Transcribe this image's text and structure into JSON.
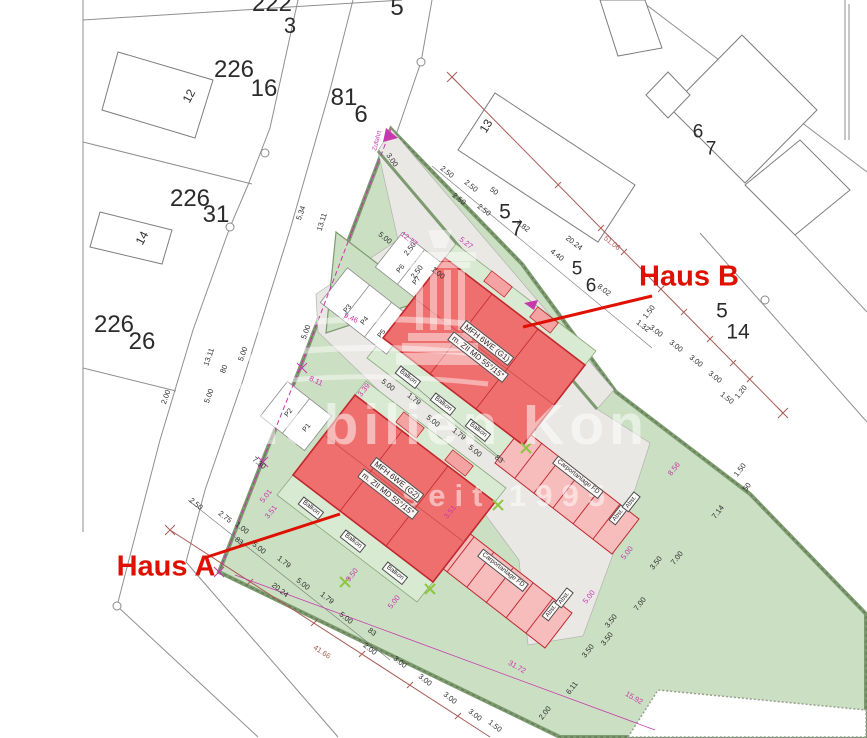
{
  "watermark": {
    "line1": "mobilien Kon",
    "line2": "seit 1995"
  },
  "colors": {
    "ink": "#2b2b2b",
    "m": "#c837ae",
    "rb": "#a85c55",
    "red": "#e01000",
    "site_green": "#cbdfc2",
    "terrace_green": "#d9ead2",
    "paving_gray": "#e9e8e5",
    "building_red": "#ef6f6e",
    "building_outline": "#c1272d",
    "carport_pink": "#f7bdbd",
    "survey_lime": "#8dc63f"
  },
  "labels": [
    {
      "t": "222",
      "x": 272,
      "y": 4,
      "s": 24,
      "n": "parcel-222"
    },
    {
      "t": "3",
      "x": 290,
      "y": 26,
      "s": 22
    },
    {
      "t": "226",
      "x": 234,
      "y": 70,
      "s": 24,
      "n": "parcel-226-16"
    },
    {
      "t": "16",
      "x": 264,
      "y": 89,
      "s": 24
    },
    {
      "t": "12",
      "x": 189,
      "y": 96,
      "r": -62,
      "s": 12,
      "n": "house-number-12"
    },
    {
      "t": "226",
      "x": 190,
      "y": 199,
      "s": 24,
      "n": "parcel-226-31"
    },
    {
      "t": "31",
      "x": 216,
      "y": 215,
      "s": 24
    },
    {
      "t": "14",
      "x": 142,
      "y": 238,
      "r": -62,
      "s": 12,
      "n": "house-number-14"
    },
    {
      "t": "226",
      "x": 114,
      "y": 325,
      "s": 24,
      "n": "parcel-226-26"
    },
    {
      "t": "26",
      "x": 142,
      "y": 342,
      "s": 24
    },
    {
      "t": "81",
      "x": 344,
      "y": 98,
      "s": 24,
      "n": "parcel-81-6"
    },
    {
      "t": "6",
      "x": 361,
      "y": 115,
      "s": 24
    },
    {
      "t": "5",
      "x": 397,
      "y": 8,
      "s": 24,
      "n": "parcel-5"
    },
    {
      "t": "13",
      "x": 486,
      "y": 126,
      "r": -58,
      "s": 12,
      "n": "house-number-13"
    },
    {
      "t": "5",
      "x": 505,
      "y": 212,
      "s": 21,
      "n": "parcel-5-7"
    },
    {
      "t": "7",
      "x": 517,
      "y": 229,
      "s": 21
    },
    {
      "t": "5",
      "x": 577,
      "y": 269,
      "s": 19,
      "n": "parcel-5-6"
    },
    {
      "t": "6",
      "x": 591,
      "y": 286,
      "s": 19
    },
    {
      "t": "6",
      "x": 698,
      "y": 132,
      "s": 19,
      "n": "parcel-6-7"
    },
    {
      "t": "7",
      "x": 711,
      "y": 149,
      "s": 19
    },
    {
      "t": "5",
      "x": 722,
      "y": 311,
      "s": 21,
      "n": "parcel-5-14"
    },
    {
      "t": "14",
      "x": 738,
      "y": 332,
      "s": 21
    },
    {
      "t": "Haus B",
      "x": 689,
      "y": 277,
      "s": 29,
      "c": "red",
      "fw": 1,
      "n": "haus-b-label"
    },
    {
      "t": "Haus A",
      "x": 166,
      "y": 567,
      "s": 29,
      "c": "red",
      "fw": 1,
      "n": "haus-a-label"
    },
    {
      "t": "MFH 6WE (G1)",
      "x": 487,
      "y": 343,
      "r": 38,
      "s": 8,
      "b": 1,
      "n": "haus-b-type-label"
    },
    {
      "t": "m. ZII MD 55°/15°",
      "x": 478,
      "y": 357,
      "r": 38,
      "s": 8,
      "b": 1,
      "n": "haus-b-roof-label"
    },
    {
      "t": "MFH 6WE (G2)",
      "x": 397,
      "y": 480,
      "r": 38,
      "s": 8,
      "b": 1,
      "n": "haus-a-type-label"
    },
    {
      "t": "m. ZII MD 55°/15°",
      "x": 388,
      "y": 494,
      "r": 38,
      "s": 8,
      "b": 1,
      "n": "haus-a-roof-label"
    },
    {
      "t": "Balkon",
      "x": 408,
      "y": 377,
      "r": 38,
      "s": 6.5,
      "b": 1
    },
    {
      "t": "Balkon",
      "x": 443,
      "y": 404,
      "r": 38,
      "s": 6.5,
      "b": 1
    },
    {
      "t": "Balkon",
      "x": 478,
      "y": 430,
      "r": 38,
      "s": 6.5,
      "b": 1
    },
    {
      "t": "Balkon",
      "x": 311,
      "y": 508,
      "r": 38,
      "s": 6.5,
      "b": 1
    },
    {
      "t": "Balkon",
      "x": 353,
      "y": 541,
      "r": 38,
      "s": 6.5,
      "b": 1
    },
    {
      "t": "Balkon",
      "x": 395,
      "y": 573,
      "r": 38,
      "s": 6.5,
      "b": 1
    },
    {
      "t": "Carportanlage FD",
      "x": 578,
      "y": 477,
      "r": 38,
      "s": 6.5,
      "b": 1
    },
    {
      "t": "Carportanlage FD",
      "x": 503,
      "y": 570,
      "r": 38,
      "s": 6.5,
      "b": 1
    },
    {
      "t": "Abst.",
      "x": 618,
      "y": 515,
      "r": -52,
      "s": 6,
      "b": 1
    },
    {
      "t": "Abst.",
      "x": 631,
      "y": 502,
      "r": -52,
      "s": 6,
      "b": 1
    },
    {
      "t": "Abst.",
      "x": 551,
      "y": 611,
      "r": -52,
      "s": 6,
      "b": 1
    },
    {
      "t": "Abst.",
      "x": 564,
      "y": 598,
      "r": -52,
      "s": 6,
      "b": 1
    },
    {
      "t": "P1",
      "x": 307,
      "y": 428,
      "r": -52,
      "s": 7
    },
    {
      "t": "P2",
      "x": 289,
      "y": 413,
      "r": -52,
      "s": 7
    },
    {
      "t": "P3",
      "x": 348,
      "y": 309,
      "r": -52,
      "s": 7
    },
    {
      "t": "P4",
      "x": 365,
      "y": 321,
      "r": -52,
      "s": 7
    },
    {
      "t": "P5",
      "x": 382,
      "y": 334,
      "r": -52,
      "s": 7
    },
    {
      "t": "P6",
      "x": 401,
      "y": 269,
      "r": -52,
      "s": 7
    },
    {
      "t": "P7",
      "x": 417,
      "y": 281,
      "r": -52,
      "s": 7
    },
    {
      "t": "Zufahrt",
      "x": 378,
      "y": 141,
      "r": -75,
      "s": 6.5,
      "c": "m",
      "n": "zufahrt-label"
    },
    {
      "t": "2.50",
      "x": 447,
      "y": 172,
      "r": 38
    },
    {
      "t": "2.50",
      "x": 471,
      "y": 186,
      "r": 38
    },
    {
      "t": "2.50",
      "x": 459,
      "y": 199,
      "r": 38
    },
    {
      "t": "50",
      "x": 494,
      "y": 191,
      "r": 38
    },
    {
      "t": "2.50",
      "x": 484,
      "y": 210,
      "r": 38
    },
    {
      "t": "7.82",
      "x": 523,
      "y": 226,
      "r": 38
    },
    {
      "t": "20.24",
      "x": 574,
      "y": 243,
      "r": 38
    },
    {
      "t": "3.00",
      "x": 392,
      "y": 160,
      "r": 55
    },
    {
      "t": "4.40",
      "x": 557,
      "y": 255,
      "r": 38
    },
    {
      "t": "8.02",
      "x": 604,
      "y": 290,
      "r": 38
    },
    {
      "t": "1.50",
      "x": 649,
      "y": 312,
      "r": -52
    },
    {
      "t": "1.32",
      "x": 643,
      "y": 326,
      "r": 38
    },
    {
      "t": "3.00",
      "x": 656,
      "y": 331,
      "r": 38
    },
    {
      "t": "3.00",
      "x": 676,
      "y": 346,
      "r": 38
    },
    {
      "t": "3.00",
      "x": 696,
      "y": 361,
      "r": 38
    },
    {
      "t": "3.00",
      "x": 715,
      "y": 377,
      "r": 38
    },
    {
      "t": "1.50",
      "x": 727,
      "y": 398,
      "r": 38
    },
    {
      "t": "1.20",
      "x": 741,
      "y": 392,
      "r": -52
    },
    {
      "t": "51.06",
      "x": 612,
      "y": 243,
      "r": 38,
      "c": "rb"
    },
    {
      "t": "2.00",
      "x": 166,
      "y": 397,
      "r": -70
    },
    {
      "t": "5.00",
      "x": 209,
      "y": 396,
      "r": -70
    },
    {
      "t": "80",
      "x": 224,
      "y": 369,
      "r": -70
    },
    {
      "t": "13.11",
      "x": 209,
      "y": 357,
      "r": -70
    },
    {
      "t": "5.00",
      "x": 243,
      "y": 354,
      "r": -70
    },
    {
      "t": "5.34",
      "x": 301,
      "y": 213,
      "r": -70
    },
    {
      "t": "13.11",
      "x": 322,
      "y": 222,
      "r": -72
    },
    {
      "t": "5.00",
      "x": 306,
      "y": 332,
      "r": -70
    },
    {
      "t": "5.00",
      "x": 385,
      "y": 238,
      "r": 38
    },
    {
      "t": "1.00",
      "x": 438,
      "y": 273,
      "r": 38
    },
    {
      "t": "2.50",
      "x": 410,
      "y": 249,
      "r": -52
    },
    {
      "t": "2.50",
      "x": 417,
      "y": 272,
      "r": -52
    },
    {
      "t": "12.77",
      "x": 409,
      "y": 239,
      "r": 38,
      "c": "m"
    },
    {
      "t": "5.27",
      "x": 466,
      "y": 243,
      "r": 38,
      "c": "m"
    },
    {
      "t": "9.46",
      "x": 351,
      "y": 318,
      "r": 25,
      "c": "m"
    },
    {
      "t": "8.11",
      "x": 316,
      "y": 381,
      "r": 25,
      "c": "m"
    },
    {
      "t": "3.39",
      "x": 364,
      "y": 390,
      "r": -52,
      "c": "m"
    },
    {
      "t": "5.00",
      "x": 388,
      "y": 385,
      "r": 38
    },
    {
      "t": "1.79",
      "x": 414,
      "y": 399,
      "r": 38
    },
    {
      "t": "5.00",
      "x": 433,
      "y": 421,
      "r": 38
    },
    {
      "t": "1.79",
      "x": 459,
      "y": 434,
      "r": 38
    },
    {
      "t": "5.00",
      "x": 475,
      "y": 451,
      "r": 38
    },
    {
      "t": "83",
      "x": 499,
      "y": 459,
      "r": 38
    },
    {
      "t": "7.30",
      "x": 259,
      "y": 463,
      "r": 38
    },
    {
      "t": "5.01",
      "x": 266,
      "y": 496,
      "r": -52,
      "c": "m"
    },
    {
      "t": "3.51",
      "x": 271,
      "y": 512,
      "r": -52,
      "c": "m"
    },
    {
      "t": "3.51",
      "x": 450,
      "y": 512,
      "r": -52,
      "c": "m"
    },
    {
      "t": "3.50",
      "x": 352,
      "y": 575,
      "r": -52,
      "c": "m"
    },
    {
      "t": "5.00",
      "x": 394,
      "y": 602,
      "r": -52,
      "c": "m"
    },
    {
      "t": "2.50",
      "x": 196,
      "y": 504,
      "r": 38
    },
    {
      "t": "2.75",
      "x": 225,
      "y": 517,
      "r": 38
    },
    {
      "t": "1.00",
      "x": 242,
      "y": 528,
      "r": 38
    },
    {
      "t": "83",
      "x": 239,
      "y": 541,
      "r": 38
    },
    {
      "t": "5.00",
      "x": 259,
      "y": 548,
      "r": 38
    },
    {
      "t": "1.79",
      "x": 284,
      "y": 562,
      "r": 38
    },
    {
      "t": "5.00",
      "x": 303,
      "y": 584,
      "r": 38
    },
    {
      "t": "1.79",
      "x": 327,
      "y": 598,
      "r": 38
    },
    {
      "t": "5.00",
      "x": 346,
      "y": 618,
      "r": 38
    },
    {
      "t": "83",
      "x": 372,
      "y": 632,
      "r": 38
    },
    {
      "t": "2.00",
      "x": 370,
      "y": 649,
      "r": 38
    },
    {
      "t": "20.24",
      "x": 280,
      "y": 590,
      "r": 38
    },
    {
      "t": "41.66",
      "x": 322,
      "y": 652,
      "r": 33,
      "c": "rb"
    },
    {
      "t": "3.00",
      "x": 400,
      "y": 662,
      "r": 38
    },
    {
      "t": "3.00",
      "x": 425,
      "y": 680,
      "r": 38
    },
    {
      "t": "3.00",
      "x": 450,
      "y": 698,
      "r": 38
    },
    {
      "t": "3.00",
      "x": 475,
      "y": 715,
      "r": 38
    },
    {
      "t": "1.50",
      "x": 495,
      "y": 726,
      "r": 38
    },
    {
      "t": "5.00",
      "x": 589,
      "y": 597,
      "r": -52,
      "c": "m"
    },
    {
      "t": "5.00",
      "x": 627,
      "y": 553,
      "r": -52,
      "c": "m"
    },
    {
      "t": "8.56",
      "x": 674,
      "y": 469,
      "r": -52,
      "c": "m"
    },
    {
      "t": "1.50",
      "x": 740,
      "y": 470,
      "r": -52
    },
    {
      "t": "50",
      "x": 747,
      "y": 487,
      "r": -52
    },
    {
      "t": "7.14",
      "x": 718,
      "y": 512,
      "r": -52
    },
    {
      "t": "3.50",
      "x": 656,
      "y": 563,
      "r": -52
    },
    {
      "t": "7.00",
      "x": 677,
      "y": 558,
      "r": -52
    },
    {
      "t": "7.00",
      "x": 640,
      "y": 604,
      "r": -52
    },
    {
      "t": "3.50",
      "x": 611,
      "y": 621,
      "r": -52
    },
    {
      "t": "3.50",
      "x": 607,
      "y": 639,
      "r": -52
    },
    {
      "t": "3.50",
      "x": 588,
      "y": 651,
      "r": -52
    },
    {
      "t": "6.11",
      "x": 572,
      "y": 688,
      "r": -52
    },
    {
      "t": "2.00",
      "x": 545,
      "y": 713,
      "r": -52
    },
    {
      "t": "31.72",
      "x": 517,
      "y": 667,
      "r": 30,
      "c": "m"
    },
    {
      "t": "15.92",
      "x": 634,
      "y": 698,
      "r": 30,
      "c": "m"
    }
  ]
}
